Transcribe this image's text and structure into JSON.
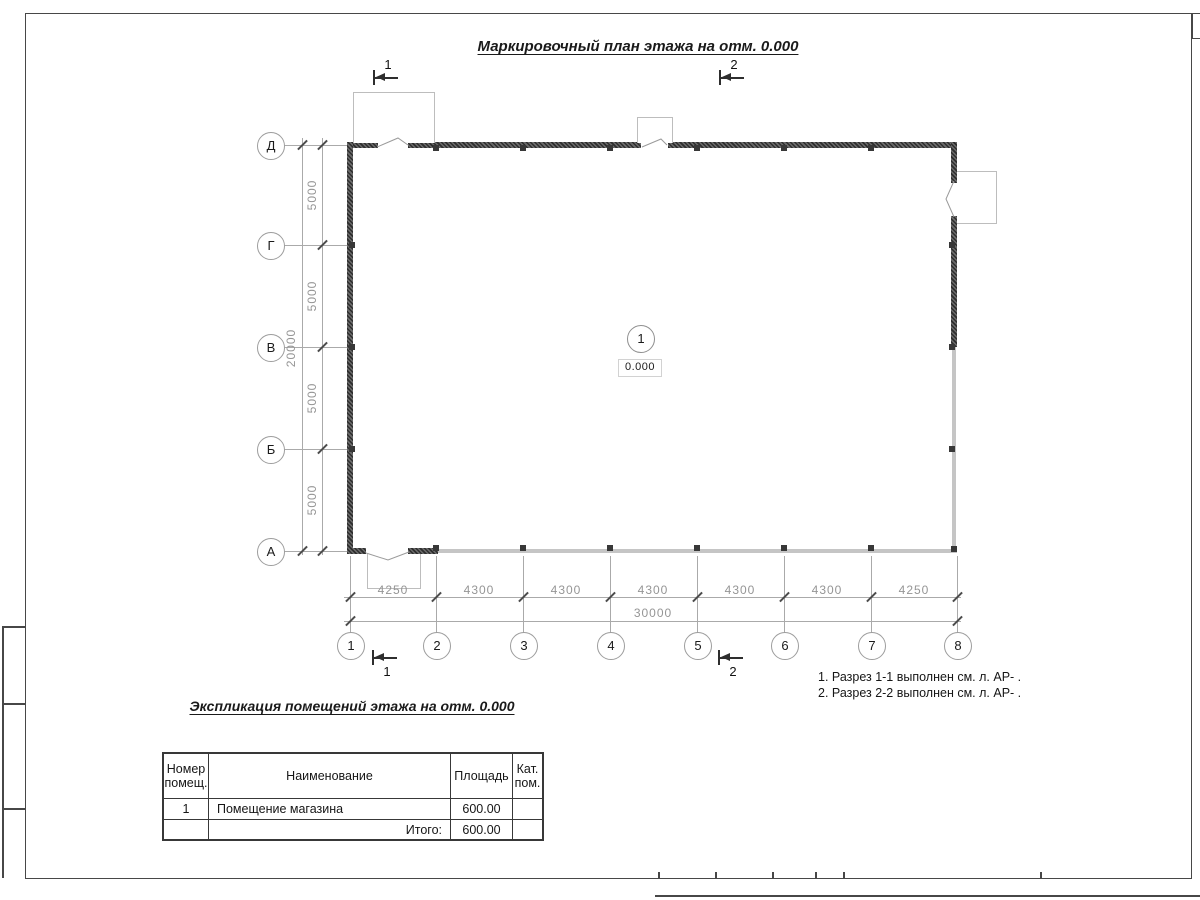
{
  "sheet": {
    "main_title": "Маркировочный план этажа на отм. 0.000"
  },
  "plan": {
    "room": {
      "number": "1",
      "elevation": "0.000"
    },
    "h_axes": [
      "1",
      "2",
      "3",
      "4",
      "5",
      "6",
      "7",
      "8"
    ],
    "v_axes": [
      "Д",
      "Г",
      "В",
      "Б",
      "А"
    ],
    "dims_bottom": {
      "segments": [
        "4250",
        "4300",
        "4300",
        "4300",
        "4300",
        "4300",
        "4250"
      ],
      "total": "30000"
    },
    "dims_left": {
      "segments": [
        "5000",
        "5000",
        "5000",
        "5000"
      ],
      "total": "20000"
    },
    "sections": {
      "s1": "1",
      "s2": "2"
    }
  },
  "notes": {
    "line1": "1. Разрез 1-1 выполнен см. л. АР- .",
    "line2": "2. Разрез 2-2 выполнен см. л. АР- ."
  },
  "explication": {
    "title": "Экспликация помещений этажа на отм. 0.000",
    "headers": {
      "num": "Номер помещ.",
      "name": "Наименование",
      "area": "Площадь",
      "cat": "Кат. пом."
    },
    "row": {
      "num": "1",
      "name": "Помещение магазина",
      "area": "600.00",
      "cat": ""
    },
    "total": {
      "label": "Итого:",
      "value": "600.00",
      "cat": ""
    }
  }
}
